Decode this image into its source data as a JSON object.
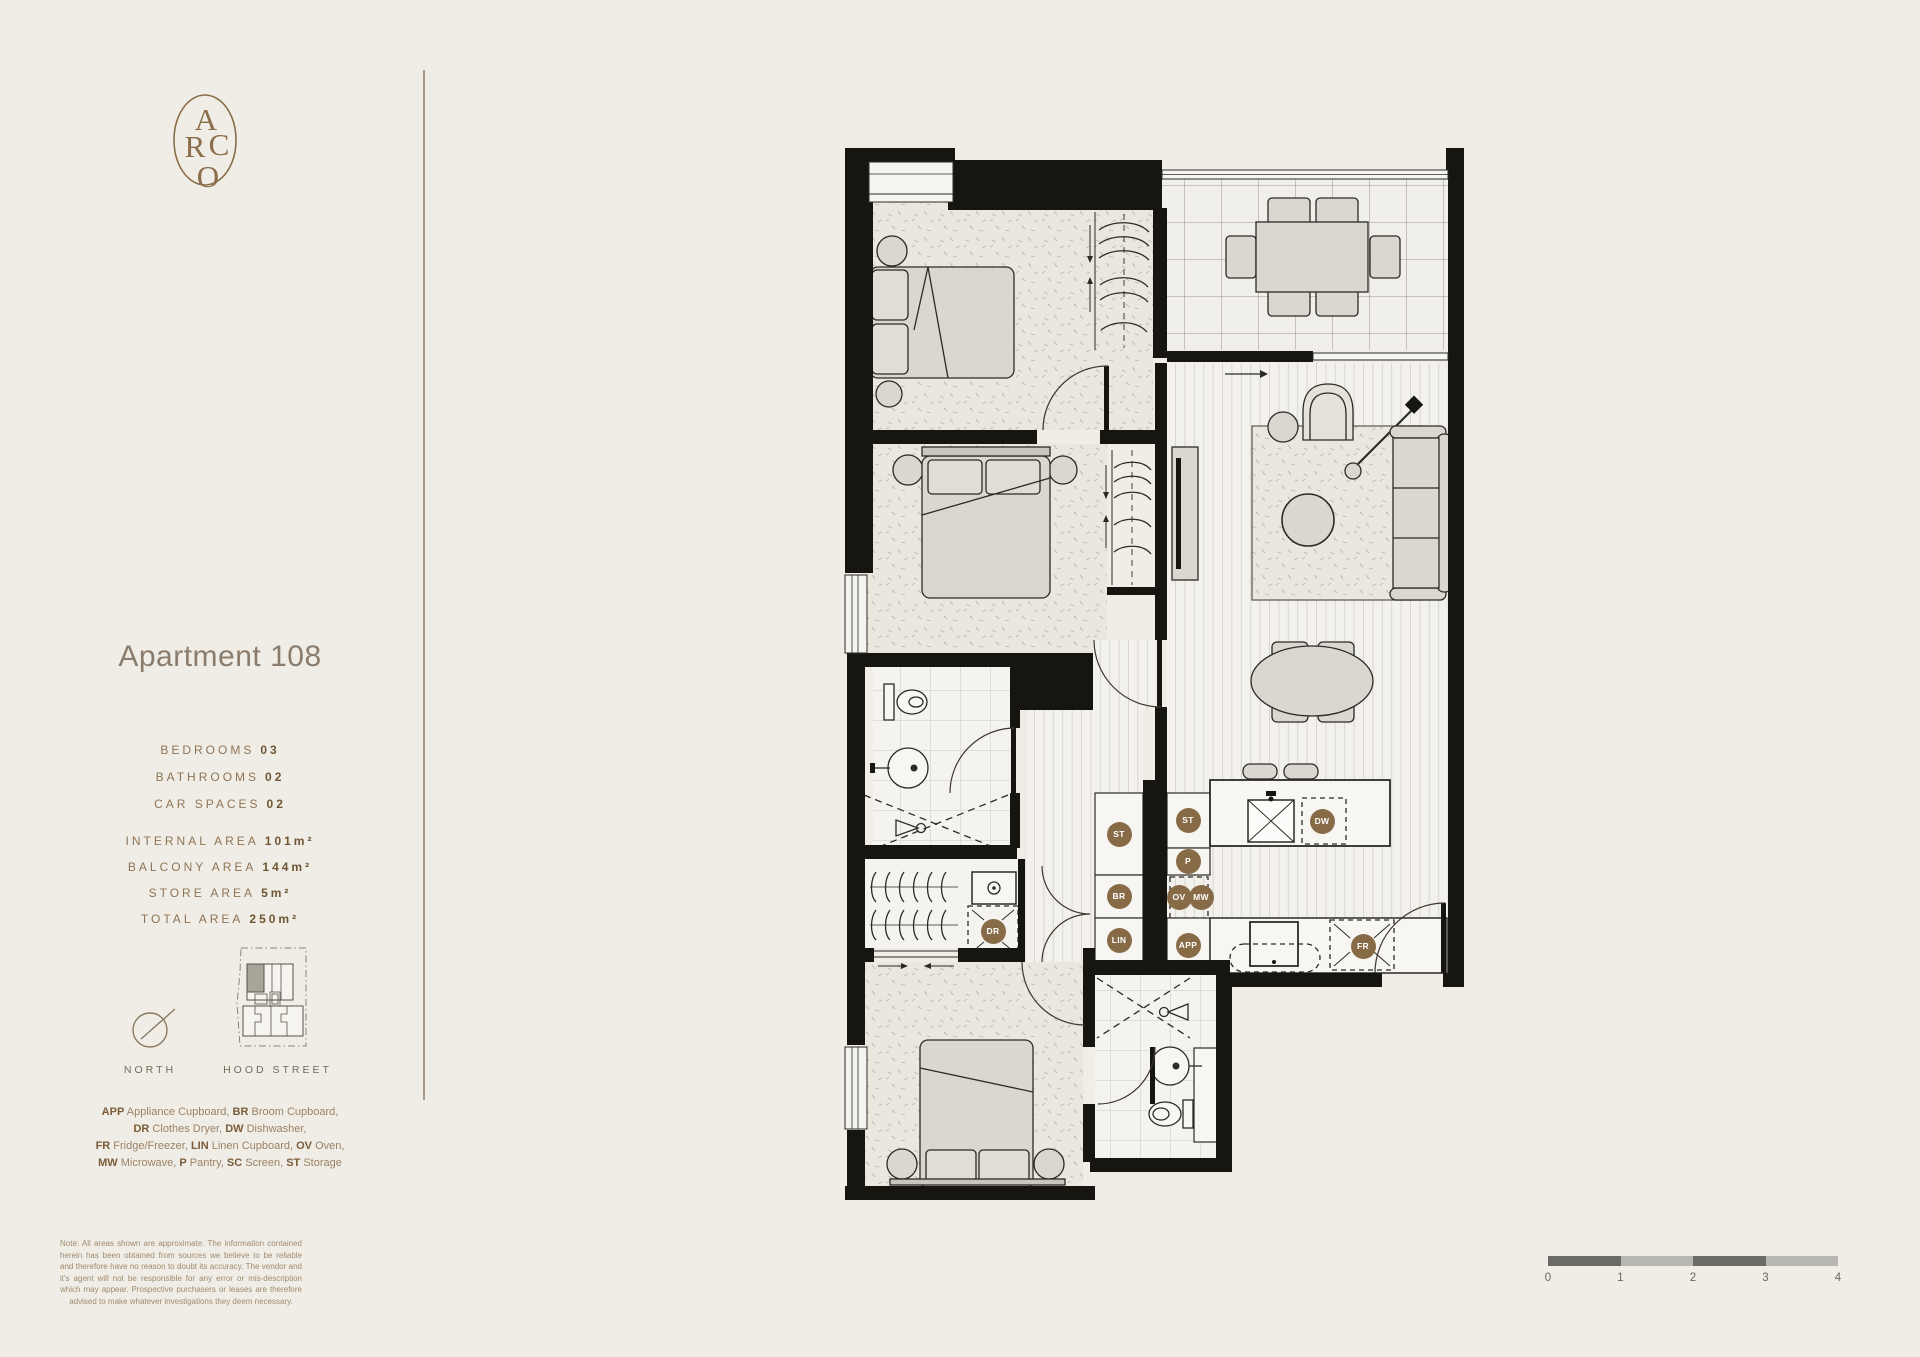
{
  "brand": {
    "letters": [
      "A",
      "R",
      "C",
      "O"
    ]
  },
  "apartment": {
    "title": "Apartment 108",
    "stats": [
      {
        "label": "BEDROOMS",
        "value": "03"
      },
      {
        "label": "BATHROOMS",
        "value": "02"
      },
      {
        "label": "CAR SPACES",
        "value": "02"
      }
    ],
    "areas": [
      {
        "label": "INTERNAL AREA",
        "value": "101m²"
      },
      {
        "label": "BALCONY AREA",
        "value": "144m²"
      },
      {
        "label": "STORE AREA",
        "value": "5m²"
      },
      {
        "label": "TOTAL AREA",
        "value": "250m²"
      }
    ]
  },
  "compass": {
    "label": "NORTH"
  },
  "keyplan": {
    "label": "HOOD STREET"
  },
  "legend": {
    "lines": [
      [
        {
          "abbr": "APP",
          "name": "Appliance Cupboard"
        },
        {
          "abbr": "BR",
          "name": "Broom Cupboard"
        }
      ],
      [
        {
          "abbr": "DR",
          "name": "Clothes Dryer"
        },
        {
          "abbr": "DW",
          "name": "Dishwasher"
        }
      ],
      [
        {
          "abbr": "FR",
          "name": "Fridge/Freezer"
        },
        {
          "abbr": "LIN",
          "name": "Linen Cupboard"
        },
        {
          "abbr": "OV",
          "name": "Oven"
        }
      ],
      [
        {
          "abbr": "MW",
          "name": "Microwave"
        },
        {
          "abbr": "P",
          "name": "Pantry"
        },
        {
          "abbr": "SC",
          "name": "Screen"
        },
        {
          "abbr": "ST",
          "name": "Storage"
        }
      ]
    ]
  },
  "note": {
    "text": "Note: All areas shown are approximate. The information contained herein has been obtained from sources we believe to be reliable and therefore have no reason to doubt its accuracy. The vendor and it's agent will not be responsible for any error or mis-description which may appear. Prospective purchasers or leases are therefore advised to make whatever investigations they deem necessary."
  },
  "plan": {
    "tag_color": "#876b46",
    "tags": [
      {
        "label": "ST",
        "x": 1119,
        "y": 834
      },
      {
        "label": "BR",
        "x": 1119,
        "y": 896
      },
      {
        "label": "LIN",
        "x": 1119,
        "y": 940
      },
      {
        "label": "ST",
        "x": 1188,
        "y": 820
      },
      {
        "label": "P",
        "x": 1188,
        "y": 861
      },
      {
        "label": "OV",
        "x": 1179,
        "y": 897
      },
      {
        "label": "MW",
        "x": 1201,
        "y": 897
      },
      {
        "label": "APP",
        "x": 1188,
        "y": 945
      },
      {
        "label": "DR",
        "x": 993,
        "y": 931
      },
      {
        "label": "DW",
        "x": 1322,
        "y": 821
      },
      {
        "label": "FR",
        "x": 1363,
        "y": 946
      }
    ]
  },
  "scalebar": {
    "ticks": [
      "0",
      "1",
      "2",
      "3",
      "4"
    ],
    "dark": "#6b6a66",
    "light": "#b9b7b1"
  }
}
